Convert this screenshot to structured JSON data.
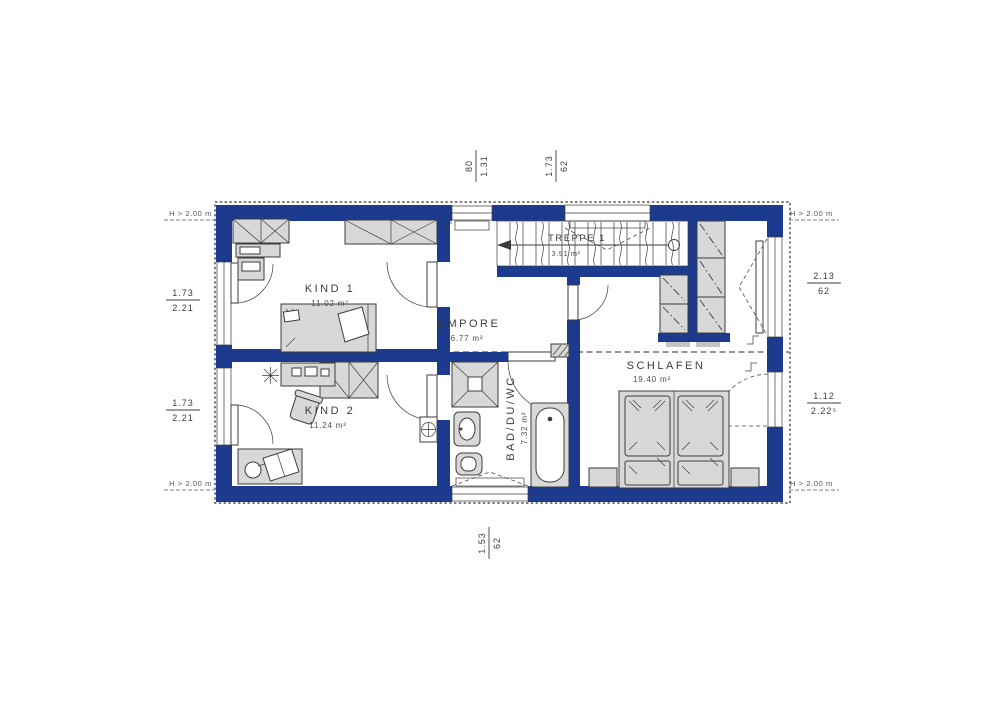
{
  "rooms": {
    "kind1": {
      "name": "KIND 1",
      "area": "11.02 m²"
    },
    "kind2": {
      "name": "KIND 2",
      "area": "11.24 m²"
    },
    "empore": {
      "name": "EMPORE",
      "area": "6.77 m²"
    },
    "bad": {
      "name": "BAD/DU/WC",
      "area": "7.32 m²"
    },
    "schlafen": {
      "name": "SCHLAFEN",
      "area": "19.40 m²"
    },
    "treppe": {
      "name": "TREPPE 1",
      "area": "3.91 m²"
    }
  },
  "dimensions": {
    "top1": {
      "num": "80",
      "den": "1.31"
    },
    "top2": {
      "num": "1.73",
      "den": "62"
    },
    "left1": {
      "num": "1.73",
      "den": "2.21"
    },
    "left2": {
      "num": "1.73",
      "den": "2.21"
    },
    "right1": {
      "num": "2.13",
      "den": "62"
    },
    "right2": {
      "num": "1.12",
      "den": "2.22⁵"
    },
    "bottom1": {
      "num": "1.53",
      "den": "62"
    }
  },
  "height_note": "H > 2.00 m",
  "colors": {
    "wall": "#1c3a8e",
    "furniture_fill": "#d8d8d8",
    "line": "#3d3d3d"
  }
}
